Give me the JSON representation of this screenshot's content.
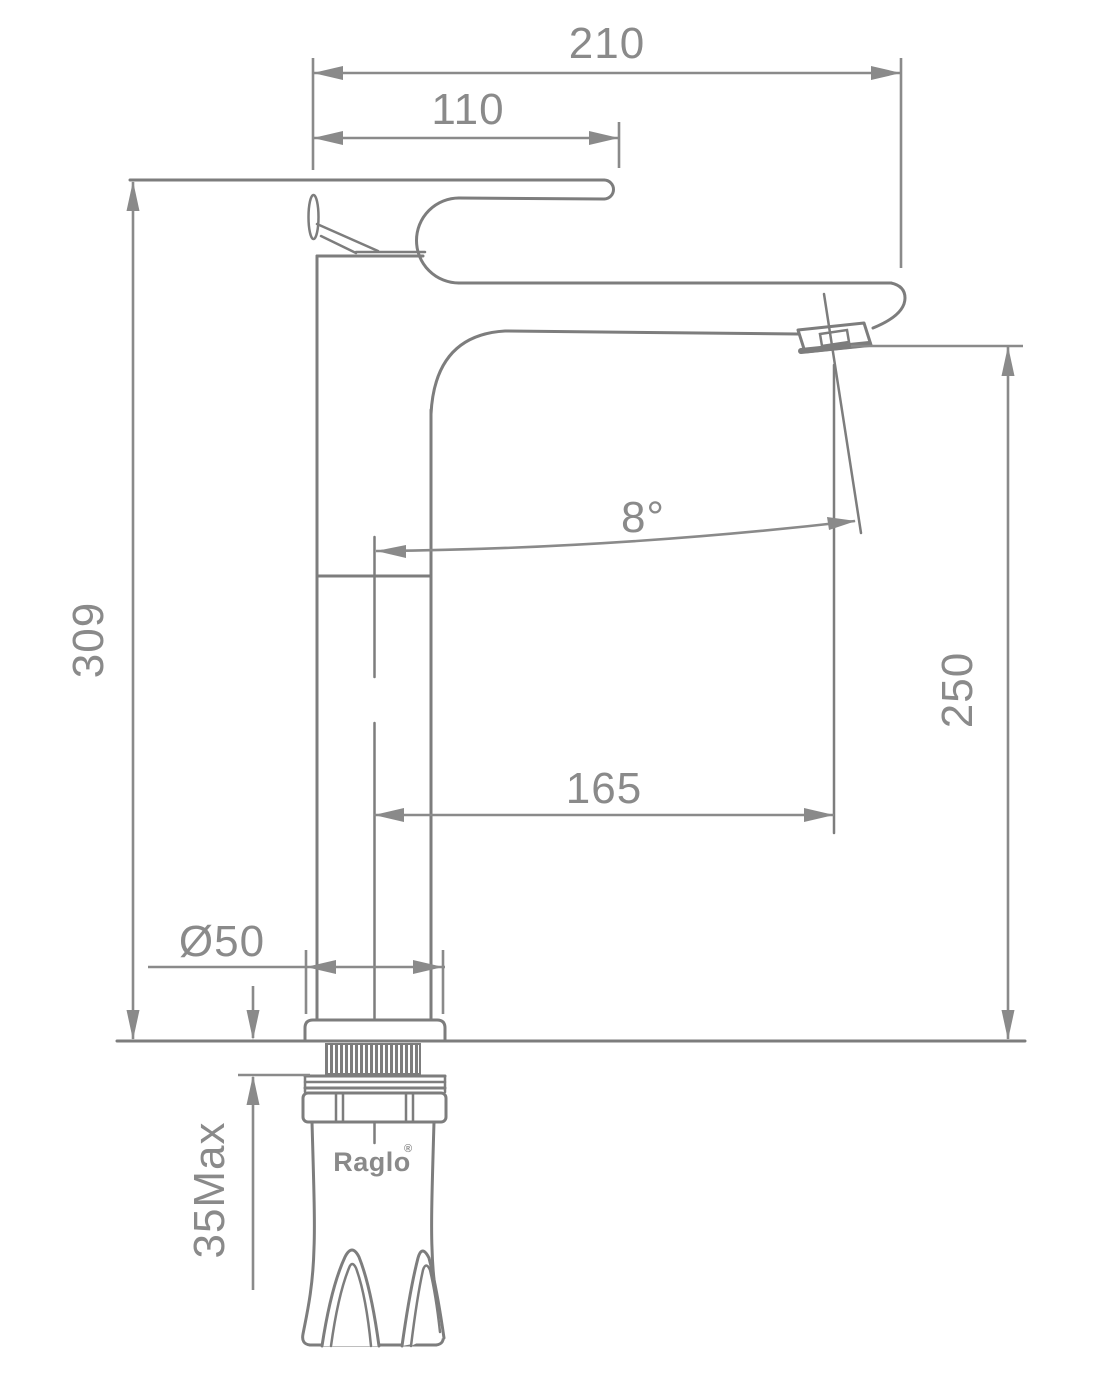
{
  "drawing": {
    "brand": "Raglo",
    "brand_mark": "®",
    "dims": {
      "overall_length": "210",
      "handle_length": "110",
      "total_height": "309",
      "spout_angle": "8°",
      "spout_height": "250",
      "spout_reach": "165",
      "base_diameter": "Ø50",
      "deck_thickness": "35Max"
    }
  }
}
